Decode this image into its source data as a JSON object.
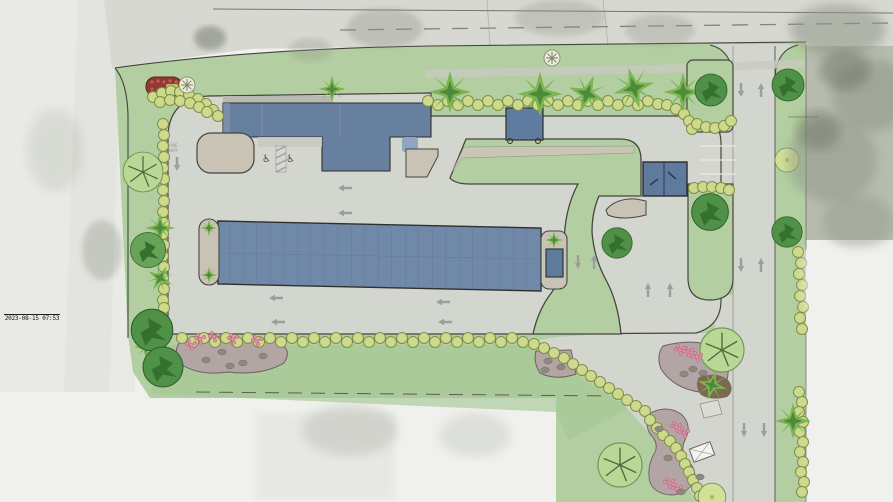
{
  "overlay": {
    "timestamp": "2023-08-15 07:53"
  },
  "icons": {
    "accessible_parking": "♿"
  },
  "pavement_labels": {
    "one_way_line1": "ONE",
    "one_way_line2": "WAY"
  },
  "colors": {
    "photo_bg": "#f0f1ee",
    "photo_left": "#e9eae6",
    "photo_road_strip": "#e0e1dc",
    "road": "#d7d8d2",
    "road_line": "#56564f",
    "center_dash": "#74746c",
    "photo_tree": "#8f9687",
    "photo_tree_dark": "#6d7466",
    "grass": "#b3cfa1",
    "lawn": "#a6c795",
    "pavement": "#d3d5cf",
    "sidewalk": "#c9c3b5",
    "gravel": "#ccc6b8",
    "building": "#68809f",
    "building_light": "#8ea6c2",
    "roof_edge": "#b9b9b3",
    "canopy": "#5f7ba0",
    "carport": "#7189a9",
    "carport_line": "#5c7192",
    "dumpster": "#5e7a9d",
    "line": "#45453f",
    "shrub": "#cdd98b",
    "shrub_edge": "#7f8e4b",
    "palm": "#7cb551",
    "palm_dark": "#4e8a3c",
    "tree_dark": "#4f9146",
    "tree_darker": "#36702f",
    "tree_mid": "#68a458",
    "tree_light": "#b9d795",
    "tree_edge": "#6f9455",
    "tree_yellow": "#d2e197",
    "branch": "#4f6b3d",
    "flower": "#e590a6",
    "flower_edge": "#b75f7b",
    "boulder": "#8d8880",
    "rockbed": "#b3a5a4",
    "mulch": "#7b6a4f",
    "arrow": "#9aa099",
    "stall": "#e9e9e2",
    "monument_red": "#8d3a33",
    "white_plant": "#eaebdc",
    "text": "#15150f"
  }
}
